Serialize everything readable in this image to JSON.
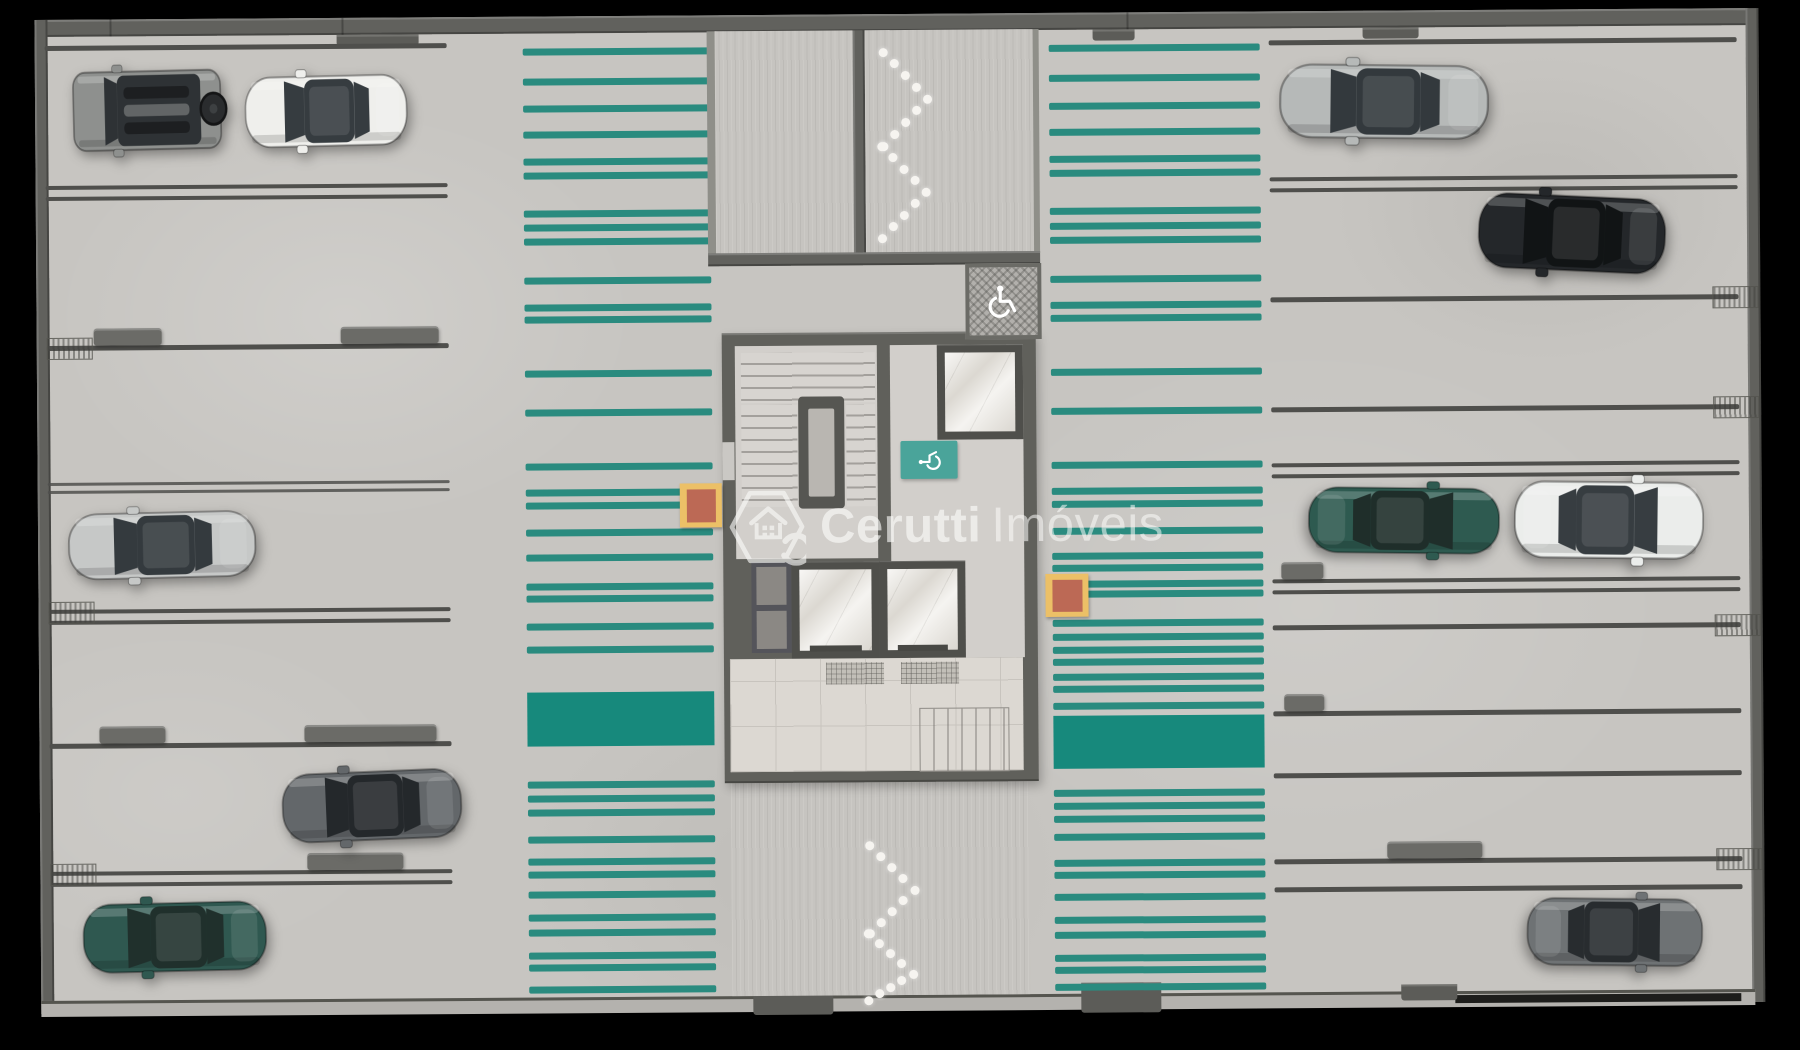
{
  "watermark": {
    "brand_bold": "Cerutti",
    "brand_light": "Imóveis",
    "logo": "hexagon-house-c-badge"
  },
  "palette": {
    "background": "#000000",
    "floor": "#c7c5c1",
    "wall": "#61615d",
    "wall_light": "#8f8f89",
    "parking_line": "#4f4f4c",
    "wheel_stop": "#6b6b67",
    "stripe": "#2a8b7f",
    "walkway_solid": "#17897c",
    "ramp_surface": "#c6c4c0",
    "marble": "#ebe8e2",
    "tile": "#dcd8d2",
    "sign_teal": "#4aa49a",
    "sign_hatched_bg": "#b2b0ac",
    "marker_outer": "#ecc067",
    "marker_inner": "#bc6955",
    "chevron_dot": "#f6f4f0",
    "watermark_white": "rgba(252,252,250,0.60)"
  },
  "walkways": {
    "left": {
      "x": 526,
      "width": 187,
      "solid_band": {
        "y": 690,
        "height": 54
      },
      "stripes": [
        46,
        76,
        103,
        129,
        156,
        170,
        208,
        222,
        236,
        275,
        302,
        314,
        368,
        407,
        461,
        487,
        500,
        527,
        552,
        581,
        593,
        621,
        644,
        779,
        793,
        807,
        834,
        856,
        869,
        889,
        912,
        927,
        950,
        962,
        984
      ]
    },
    "right": {
      "x": 1052,
      "width": 211,
      "solid_band": {
        "y": 717,
        "height": 53
      },
      "stripes": [
        46,
        76,
        104,
        130,
        157,
        171,
        209,
        224,
        238,
        277,
        303,
        316,
        370,
        409,
        463,
        489,
        502,
        529,
        554,
        566,
        582,
        592,
        621,
        635,
        648,
        660,
        675,
        687,
        704,
        791,
        804,
        817,
        835,
        861,
        873,
        895,
        918,
        933,
        956,
        968,
        985
      ]
    }
  },
  "ramps": {
    "top": {
      "x": 718,
      "y": 30,
      "width": 318,
      "height": 224,
      "divider_x": 856,
      "chevrons": [
        {
          "apex_x": 930,
          "wing_x": 886,
          "y_top": 52,
          "y_mid": 99,
          "y_bot": 146
        },
        {
          "apex_x": 928,
          "wing_x": 884,
          "y_top": 146,
          "y_mid": 192,
          "y_bot": 238
        }
      ]
    },
    "bottom": {
      "x": 729,
      "y": 782,
      "width": 298,
      "height": 213,
      "chevrons": [
        {
          "apex_x": 912,
          "wing_x": 867,
          "y_top": 845,
          "y_mid": 890,
          "y_bot": 933
        },
        {
          "apex_x": 910,
          "wing_x": 865,
          "y_top": 933,
          "y_mid": 974,
          "y_bot": 1000
        }
      ]
    }
  },
  "parking_rows": [
    {
      "side": "left",
      "y": 40,
      "style": "single"
    },
    {
      "side": "left",
      "y": 180,
      "style": "double"
    },
    {
      "side": "left",
      "y": 340,
      "style": "single",
      "symbol": true,
      "stops": [
        [
          95,
          68
        ],
        [
          342,
          98
        ]
      ]
    },
    {
      "side": "left",
      "y": 477,
      "style": "double_thin"
    },
    {
      "side": "left",
      "y": 604,
      "style": "double",
      "symbol": true
    },
    {
      "side": "left",
      "y": 738,
      "style": "single",
      "stops": [
        [
          98,
          66
        ],
        [
          303,
          132
        ]
      ]
    },
    {
      "side": "left",
      "y": 866,
      "style": "double",
      "symbol": true,
      "stops": [
        [
          305,
          96
        ]
      ]
    },
    {
      "side": "right",
      "y": 43,
      "style": "single"
    },
    {
      "side": "right",
      "y": 180,
      "style": "double"
    },
    {
      "side": "right",
      "y": 300,
      "style": "single",
      "symbol": true
    },
    {
      "side": "right",
      "y": 410,
      "style": "single",
      "symbol": true
    },
    {
      "side": "right",
      "y": 466,
      "style": "double"
    },
    {
      "side": "right",
      "y": 582,
      "style": "double",
      "stops": [
        [
          1281,
          42
        ]
      ]
    },
    {
      "side": "right",
      "y": 628,
      "style": "single",
      "symbol": true
    },
    {
      "side": "right",
      "y": 714,
      "style": "single",
      "stops": [
        [
          1283,
          40
        ]
      ]
    },
    {
      "side": "right",
      "y": 776,
      "style": "single"
    },
    {
      "side": "right",
      "y": 862,
      "style": "single",
      "symbol": true,
      "stops": [
        [
          1385,
          95
        ]
      ]
    },
    {
      "side": "right",
      "y": 890,
      "style": "single"
    }
  ],
  "row_geometry": {
    "left_x": 48,
    "left_w": 402,
    "right_x": 1272,
    "right_w": 468
  },
  "signs": [
    {
      "name": "accessible-parking-sign",
      "icon": "wheelchair-icon",
      "x": 967,
      "y": 264,
      "w": 68,
      "h": 68,
      "style": "hatched"
    },
    {
      "name": "accessible-route-sign",
      "icon": "wheelchair-icon",
      "x": 901,
      "y": 441,
      "w": 57,
      "h": 38,
      "style": "teal"
    }
  ],
  "markers": [
    {
      "name": "fire-equipment-marker",
      "x": 680,
      "y": 482,
      "w": 42,
      "h": 44
    },
    {
      "name": "fire-equipment-marker",
      "x": 1045,
      "y": 575,
      "w": 43,
      "h": 43
    }
  ],
  "cars": [
    {
      "name": "suv-gray-top-left",
      "type": "suv",
      "x": 74,
      "y": 58,
      "w": 160,
      "h": 94,
      "angle": -1,
      "flip": false,
      "body": "#8e908e",
      "glass": "#2e3235"
    },
    {
      "name": "sedan-white-top-left",
      "type": "sedan",
      "x": 246,
      "y": 62,
      "w": 166,
      "h": 90,
      "angle": -1,
      "flip": false,
      "body": "#efefec",
      "glass": "#363c40"
    },
    {
      "name": "sedan-silver-left",
      "type": "sedan",
      "x": 66,
      "y": 498,
      "w": 192,
      "h": 84,
      "angle": -1,
      "flip": false,
      "body": "#c6c8c7",
      "glass": "#343a3e"
    },
    {
      "name": "hatchback-gray-left",
      "type": "sedan",
      "x": 278,
      "y": 758,
      "w": 184,
      "h": 88,
      "angle": -2,
      "flip": false,
      "body": "#63676a",
      "glass": "#24282b"
    },
    {
      "name": "sedan-teal-left",
      "type": "sedan",
      "x": 78,
      "y": 888,
      "w": 188,
      "h": 88,
      "angle": -1,
      "flip": false,
      "body": "#2f5850",
      "glass": "#20302c"
    },
    {
      "name": "sedan-silver-right-top",
      "type": "sedan",
      "x": 1280,
      "y": 58,
      "w": 214,
      "h": 94,
      "angle": 1,
      "flip": false,
      "body": "#b6b9b8",
      "glass": "#33393d"
    },
    {
      "name": "sedan-black-right",
      "type": "sedan",
      "x": 1478,
      "y": 190,
      "w": 192,
      "h": 96,
      "angle": 3,
      "flip": false,
      "body": "#24272a",
      "glass": "#111415"
    },
    {
      "name": "coupe-teal-right",
      "type": "sedan",
      "x": 1306,
      "y": 482,
      "w": 196,
      "h": 84,
      "angle": 1,
      "flip": true,
      "body": "#2e5a50",
      "glass": "#1f2e2a"
    },
    {
      "name": "sedan-white-right",
      "type": "sedan",
      "x": 1512,
      "y": 476,
      "w": 194,
      "h": 98,
      "angle": 1,
      "flip": true,
      "body": "#ebedeb",
      "glass": "#373d41"
    },
    {
      "name": "hatchback-gray-right",
      "type": "sedan",
      "x": 1522,
      "y": 894,
      "w": 180,
      "h": 86,
      "angle": 1,
      "flip": true,
      "body": "#6e7274",
      "glass": "#282c2f"
    }
  ]
}
